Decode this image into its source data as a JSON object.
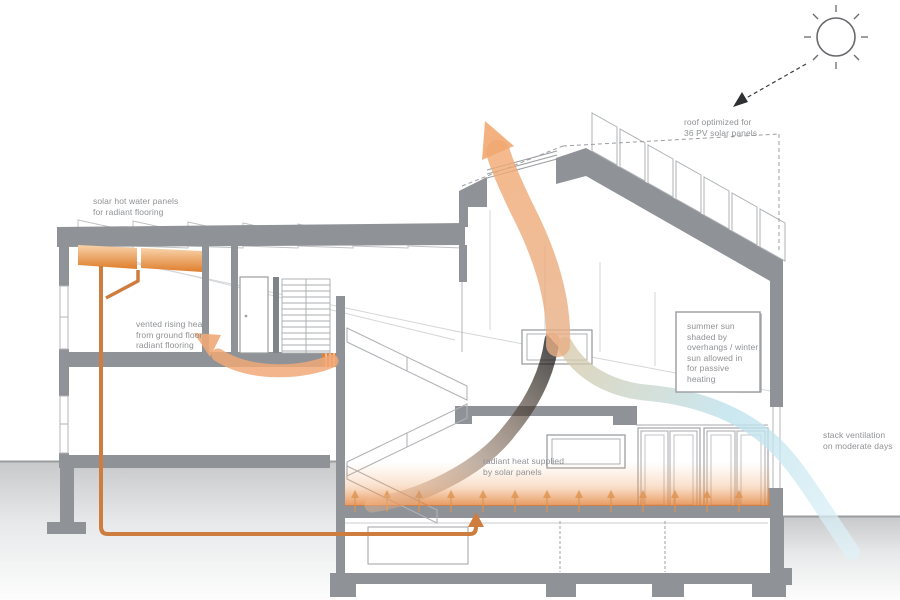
{
  "diagram": {
    "type": "passive-solar-house-cross-section",
    "labels": {
      "solar_hot_water": {
        "l1": "solar hot water panels",
        "l2": "for radiant flooring"
      },
      "vented_heat": {
        "l1": "vented rising heat",
        "l2": "from ground floor",
        "l3": "radiant flooring"
      },
      "pv_roof": {
        "l1": "roof optimized for",
        "l2": "36 PV solar panels"
      },
      "summer_sun": {
        "l1": "summer sun",
        "l2": "shaded by",
        "l3": "overhangs / winter",
        "l4": "sun allowed in",
        "l5": "for passive",
        "l6": "heating"
      },
      "stack_vent": {
        "l1": "stack ventilation",
        "l2": "on moderate days"
      },
      "radiant_heat": {
        "l1": "radiant heat supplied",
        "l2": "by solar panels"
      }
    },
    "colors": {
      "wall_gray": "#8f9296",
      "dark_gray": "#7e8185",
      "line_gray": "#9b9da0",
      "faint_gray": "#c9cbcd",
      "ground_gray": "#c7c9cb",
      "pipe_orange": "#cf7d3e",
      "collector_orange": "#e8873a",
      "arrow_orange": "#f2a871",
      "vent_blue": "#b8dfe9",
      "text_gray": "#8f9194"
    },
    "icon_names": [
      "sun-icon",
      "sun-ray-arrow",
      "heat-rise-arrow",
      "stack-vent-arrow",
      "radiant-pipe",
      "floor-heat-arrows"
    ]
  }
}
